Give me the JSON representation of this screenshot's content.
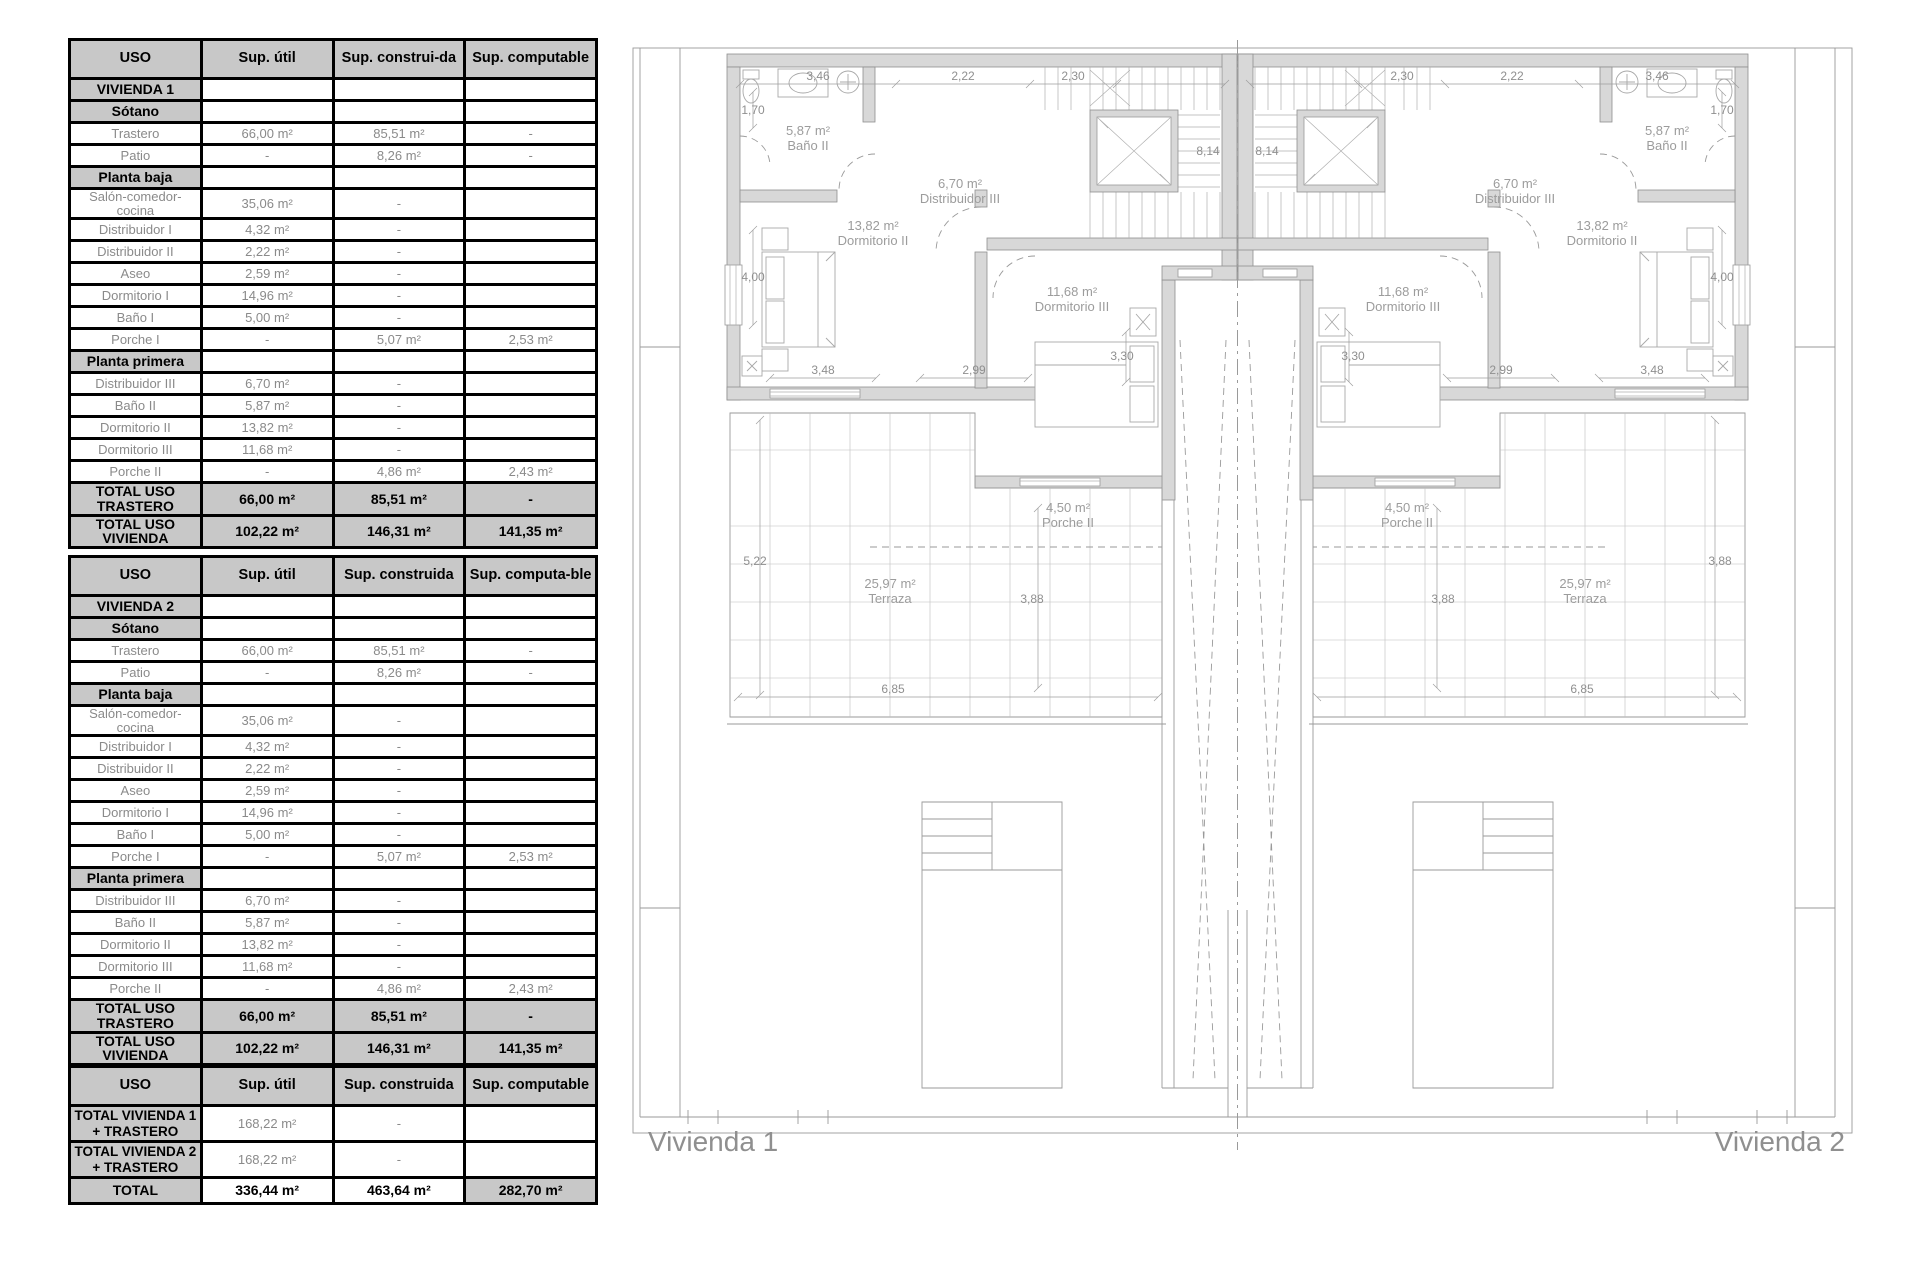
{
  "tables": {
    "t1": {
      "columns": [
        "USO",
        "Sup. útil",
        "Sup. construi-da",
        "Sup. computable"
      ],
      "rows": [
        {
          "type": "section",
          "cells": [
            "VIVIENDA 1",
            "",
            "",
            ""
          ]
        },
        {
          "type": "section",
          "cells": [
            "Sótano",
            "",
            "",
            ""
          ]
        },
        {
          "type": "data",
          "cells": [
            "Trastero",
            "66,00 m²",
            "85,51 m²",
            "-"
          ]
        },
        {
          "type": "data",
          "cells": [
            "Patio",
            "-",
            "8,26 m²",
            "-"
          ]
        },
        {
          "type": "section",
          "cells": [
            "Planta baja",
            "",
            "",
            ""
          ]
        },
        {
          "type": "data",
          "cells": [
            "Salón-comedor-cocina",
            "35,06 m²",
            "-",
            ""
          ]
        },
        {
          "type": "data",
          "cells": [
            "Distribuidor I",
            "4,32 m²",
            "-",
            ""
          ]
        },
        {
          "type": "data",
          "cells": [
            "Distribuidor II",
            "2,22 m²",
            "-",
            ""
          ]
        },
        {
          "type": "data",
          "cells": [
            "Aseo",
            "2,59 m²",
            "-",
            ""
          ]
        },
        {
          "type": "data",
          "cells": [
            "Dormitorio I",
            "14,96 m²",
            "-",
            ""
          ]
        },
        {
          "type": "data",
          "cells": [
            "Baño I",
            "5,00 m²",
            "-",
            ""
          ]
        },
        {
          "type": "data",
          "cells": [
            "Porche I",
            "-",
            "5,07 m²",
            "2,53 m²"
          ]
        },
        {
          "type": "section",
          "cells": [
            "Planta primera",
            "",
            "",
            ""
          ]
        },
        {
          "type": "data",
          "cells": [
            "Distribuidor III",
            "6,70 m²",
            "-",
            ""
          ]
        },
        {
          "type": "data",
          "cells": [
            "Baño II",
            "5,87 m²",
            "-",
            ""
          ]
        },
        {
          "type": "data",
          "cells": [
            "Dormitorio II",
            "13,82 m²",
            "-",
            ""
          ]
        },
        {
          "type": "data",
          "cells": [
            "Dormitorio III",
            "11,68 m²",
            "-",
            ""
          ]
        },
        {
          "type": "data",
          "cells": [
            "Porche II",
            "-",
            "4,86 m²",
            "2,43 m²"
          ]
        },
        {
          "type": "total",
          "cells": [
            "TOTAL USO TRASTERO",
            "66,00 m²",
            "85,51 m²",
            "-"
          ]
        },
        {
          "type": "total",
          "cells": [
            "TOTAL USO VIVIENDA",
            "102,22 m²",
            "146,31 m²",
            "141,35 m²"
          ]
        }
      ]
    },
    "t2": {
      "columns": [
        "USO",
        "Sup. útil",
        "Sup. construida",
        "Sup. computa-ble"
      ],
      "rows": [
        {
          "type": "section",
          "cells": [
            "VIVIENDA 2",
            "",
            "",
            ""
          ]
        },
        {
          "type": "section",
          "cells": [
            "Sótano",
            "",
            "",
            ""
          ]
        },
        {
          "type": "data",
          "cells": [
            "Trastero",
            "66,00 m²",
            "85,51 m²",
            "-"
          ]
        },
        {
          "type": "data",
          "cells": [
            "Patio",
            "-",
            "8,26 m²",
            "-"
          ]
        },
        {
          "type": "section",
          "cells": [
            "Planta baja",
            "",
            "",
            ""
          ]
        },
        {
          "type": "data",
          "cells": [
            "Salón-comedor-cocina",
            "35,06 m²",
            "-",
            ""
          ]
        },
        {
          "type": "data",
          "cells": [
            "Distribuidor I",
            "4,32 m²",
            "-",
            ""
          ]
        },
        {
          "type": "data",
          "cells": [
            "Distribuidor II",
            "2,22 m²",
            "-",
            ""
          ]
        },
        {
          "type": "data",
          "cells": [
            "Aseo",
            "2,59 m²",
            "-",
            ""
          ]
        },
        {
          "type": "data",
          "cells": [
            "Dormitorio I",
            "14,96 m²",
            "-",
            ""
          ]
        },
        {
          "type": "data",
          "cells": [
            "Baño I",
            "5,00 m²",
            "-",
            ""
          ]
        },
        {
          "type": "data",
          "cells": [
            "Porche I",
            "-",
            "5,07 m²",
            "2,53 m²"
          ]
        },
        {
          "type": "section",
          "cells": [
            "Planta primera",
            "",
            "",
            ""
          ]
        },
        {
          "type": "data",
          "cells": [
            "Distribuidor III",
            "6,70 m²",
            "-",
            ""
          ]
        },
        {
          "type": "data",
          "cells": [
            "Baño II",
            "5,87 m²",
            "-",
            ""
          ]
        },
        {
          "type": "data",
          "cells": [
            "Dormitorio II",
            "13,82 m²",
            "-",
            ""
          ]
        },
        {
          "type": "data",
          "cells": [
            "Dormitorio III",
            "11,68 m²",
            "-",
            ""
          ]
        },
        {
          "type": "data",
          "cells": [
            "Porche II",
            "-",
            "4,86 m²",
            "2,43 m²"
          ]
        },
        {
          "type": "total",
          "cells": [
            "TOTAL USO TRASTERO",
            "66,00 m²",
            "85,51 m²",
            "-"
          ]
        },
        {
          "type": "total",
          "cells": [
            "TOTAL USO VIVIENDA",
            "102,22 m²",
            "146,31 m²",
            "141,35 m²"
          ]
        }
      ]
    },
    "t3": {
      "columns": [
        "USO",
        "Sup. útil",
        "Sup. construida",
        "Sup. computable"
      ],
      "rows": [
        {
          "type": "labelbold",
          "cells": [
            "TOTAL VIVIENDA 1 + TRASTERO",
            "168,22 m²",
            "-",
            ""
          ]
        },
        {
          "type": "labelbold",
          "cells": [
            "TOTAL VIVIENDA 2 + TRASTERO",
            "168,22 m²",
            "-",
            ""
          ]
        },
        {
          "type": "mixed",
          "bg": [
            "g",
            "w",
            "w",
            "g"
          ],
          "cells": [
            "TOTAL",
            "336,44 m²",
            "463,64 m²",
            "282,70 m²"
          ]
        }
      ]
    }
  },
  "plan": {
    "caption_left": "Vivienda 1",
    "caption_right": "Vivienda 2",
    "rooms": {
      "bano": {
        "area": "5,87 m²",
        "name": "Baño II"
      },
      "distribuidor": {
        "area": "6,70 m²",
        "name": "Distribuidor III"
      },
      "dorm2": {
        "area": "13,82 m²",
        "name": "Dormitorio II"
      },
      "dorm3": {
        "area": "11,68 m²",
        "name": "Dormitorio III"
      },
      "porche": {
        "area": "4,50 m²",
        "name": "Porche II"
      },
      "terraza": {
        "area": "25,97 m²",
        "name": "Terraza"
      }
    },
    "dims": {
      "d346": "3,46",
      "d222": "2,22",
      "d230": "2,30",
      "d170": "1,70",
      "d814": "8,14",
      "d400": "4,00",
      "d348": "3,48",
      "d299": "2,99",
      "d330": "3,30",
      "d522": "5,22",
      "d388": "3,88",
      "d685": "6,85"
    }
  }
}
